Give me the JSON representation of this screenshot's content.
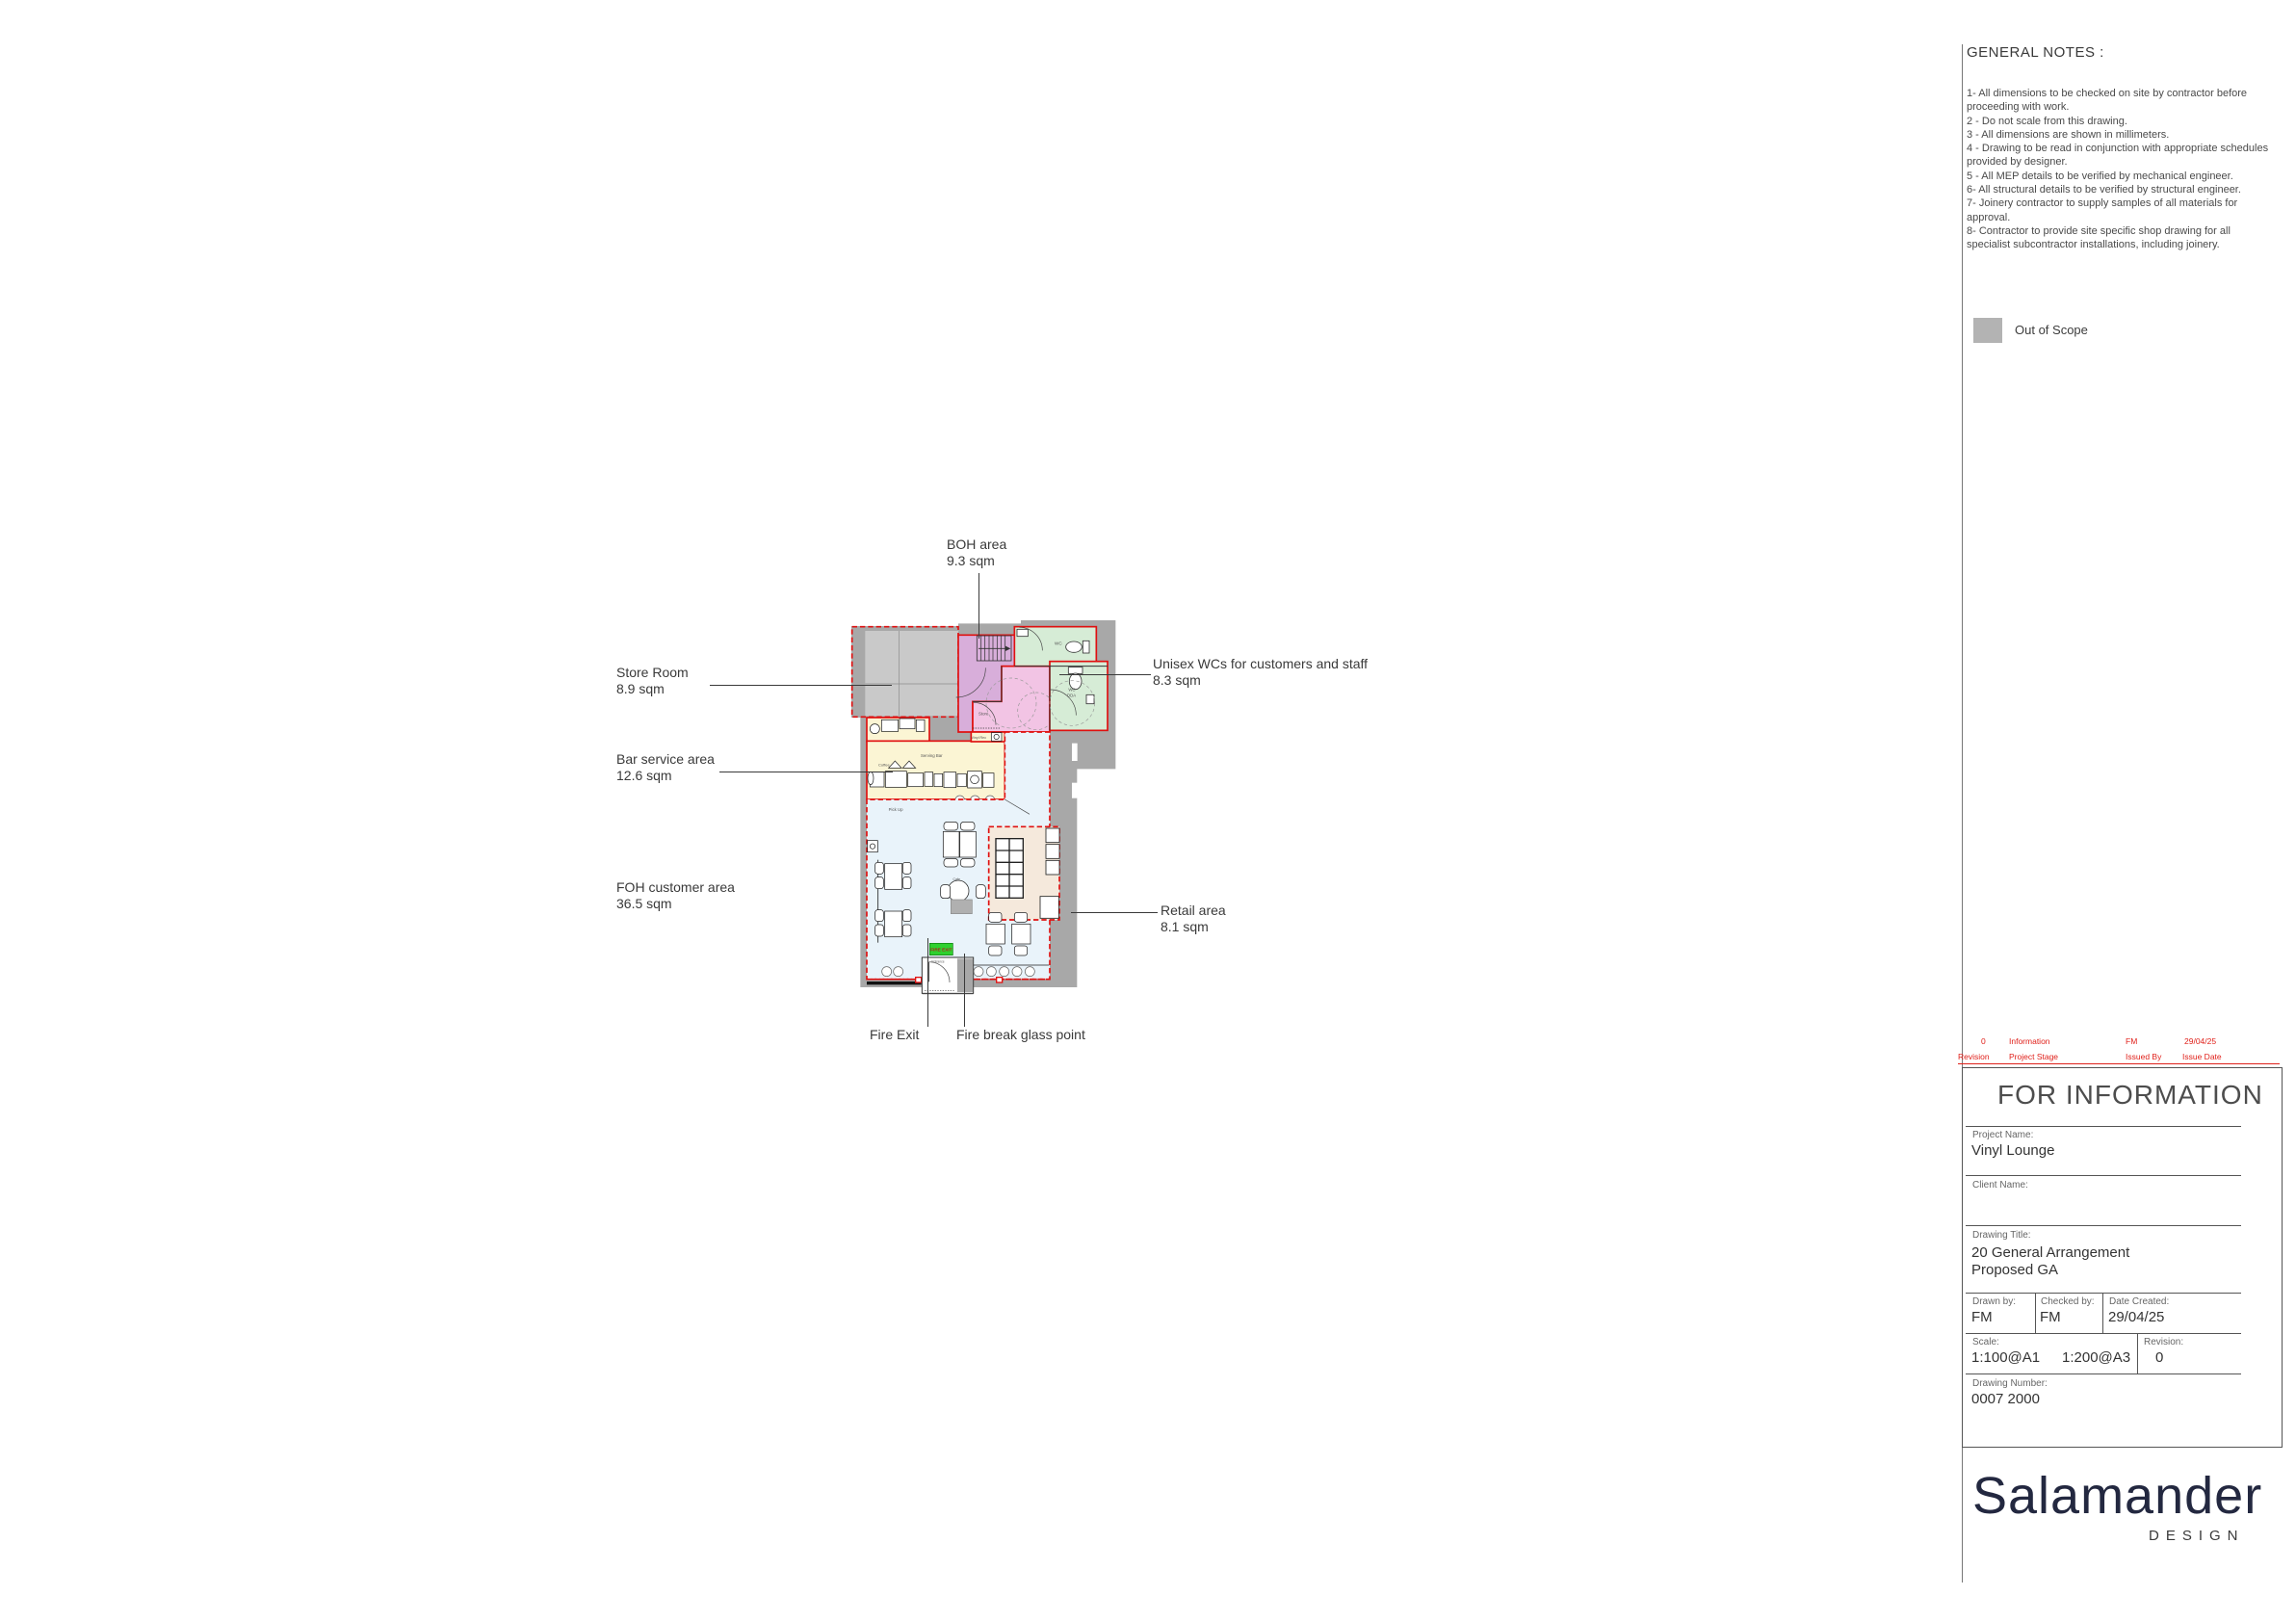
{
  "notes_panel": {
    "title": "GENERAL NOTES :",
    "notes": [
      "1- All dimensions to be checked on site by contractor before proceeding with work.",
      "2 - Do not scale from this drawing.",
      "3 - All dimensions are shown in millimeters.",
      "4 - Drawing to be read in conjunction with appropriate schedules provided by designer.",
      "5 - All MEP details to be verified by mechanical engineer.",
      "6- All structural details to be verified by structural engineer.",
      "7- Joinery contractor to supply samples of all materials for approval.",
      "8- Contractor to provide site specific shop drawing for all specialist subcontractor installations, including joinery."
    ],
    "legend": {
      "label": "Out of Scope",
      "swatch_color": "#b3b3b3"
    }
  },
  "plan": {
    "annotations": [
      {
        "label": "BOH area",
        "area": "9.3 sqm"
      },
      {
        "label": "Store Room",
        "area": "8.9 sqm"
      },
      {
        "label": "Unisex WCs for customers and staff",
        "area": "8.3 sqm"
      },
      {
        "label": "Bar service area",
        "area": "12.6 sqm"
      },
      {
        "label": "FOH customer area",
        "area": "36.5 sqm"
      },
      {
        "label": "Retail area",
        "area": "8.1 sqm"
      },
      {
        "label": "Fire Exit"
      },
      {
        "label": "Fire break glass point"
      }
    ],
    "room_labels": {
      "store": "Store",
      "wc": "WC",
      "wc2": "WC",
      "dda": "DDA",
      "serving_bar": "Serving Bar",
      "coffee": "Coffee",
      "pick_up": "Pick Up",
      "cafe": "Cafe",
      "entrance": "Entrance",
      "vinyl": "Vinyl Rec",
      "fire_exit_sign": "FIRE EXIT"
    },
    "zone_colors": {
      "wall_gray": "#a8a8a8",
      "out_of_scope_room": "#c9c9c9",
      "boh_violet": "#d8aeda",
      "store_pink": "#f2c4e4",
      "wc_green": "#d6ecd6",
      "bar_yellow": "#fbf5d4",
      "foh_blue": "#e9f3fa",
      "retail_tan": "#f5e9dc",
      "boundary_red": "#e01010",
      "fire_exit_green": "#2fd12f"
    }
  },
  "revision_table": {
    "headers": {
      "revision": "Revision",
      "project_stage": "Project Stage",
      "issued_by": "Issued By",
      "issue_date": "Issue Date"
    },
    "rows": [
      {
        "revision": "0",
        "project_stage": "Information",
        "issued_by": "FM",
        "issue_date": "29/04/25"
      }
    ]
  },
  "title_block": {
    "status": "FOR INFORMATION",
    "project_name_label": "Project Name:",
    "project_name": "Vinyl Lounge",
    "client_name_label": "Client Name:",
    "client_name": "",
    "drawing_title_label": "Drawing Title:",
    "drawing_title_line1": "20 General Arrangement",
    "drawing_title_line2": "Proposed GA",
    "drawn_by_label": "Drawn by:",
    "drawn_by": "FM",
    "checked_by_label": "Checked by:",
    "checked_by": "FM",
    "date_created_label": "Date Created:",
    "date_created": "29/04/25",
    "scale_label": "Scale:",
    "scale_a1": "1:100@A1",
    "scale_a3": "1:200@A3",
    "revision_label": "Revision:",
    "revision": "0",
    "drawing_number_label": "Drawing Number:",
    "drawing_number": "0007 2000"
  },
  "logo": {
    "name": "Salamander",
    "subtitle": "DESIGN"
  }
}
